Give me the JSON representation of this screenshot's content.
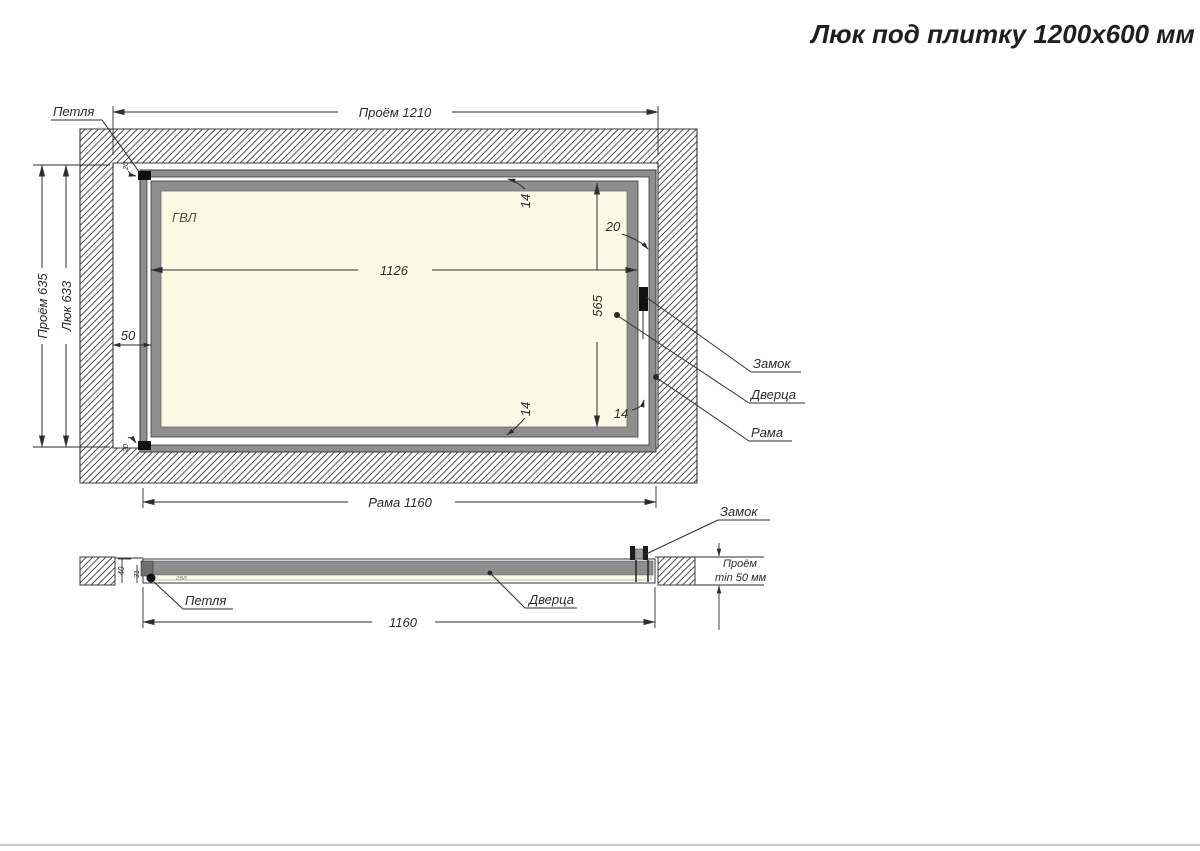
{
  "title": "Люк под плитку 1200х600 мм",
  "plan": {
    "panel_label": "ГВЛ",
    "hinge_label": "Петля",
    "lock_label": "Замок",
    "door_label": "Дверца",
    "frame_label": "Рама",
    "dims": {
      "opening_width": "Проём 1210",
      "opening_height": "Проём 635",
      "hatch_height": "Люк 633",
      "frame_width": "Рама 1160",
      "door_width": "1126",
      "door_height": "565",
      "left_gap": "50",
      "lock_gap": "20",
      "top_gap": "14",
      "bottom_gap": "14",
      "bottom_right_gap": "14",
      "hinge_offset_top": "20",
      "hinge_offset_bottom": "20"
    }
  },
  "section": {
    "hinge_label": "Петля",
    "door_label": "Дверца",
    "lock_label": "Замок",
    "panel_label": "гвл",
    "dims": {
      "frame_width": "1160",
      "frame_depth": "40",
      "door_depth": "31",
      "opening_note_line1": "Проём",
      "opening_note_line2": "min 50 мм"
    }
  },
  "colors": {
    "frame_gray": "#8e8e8e",
    "panel_cream": "#fbfae6",
    "line_dark": "#2e2e2e"
  }
}
